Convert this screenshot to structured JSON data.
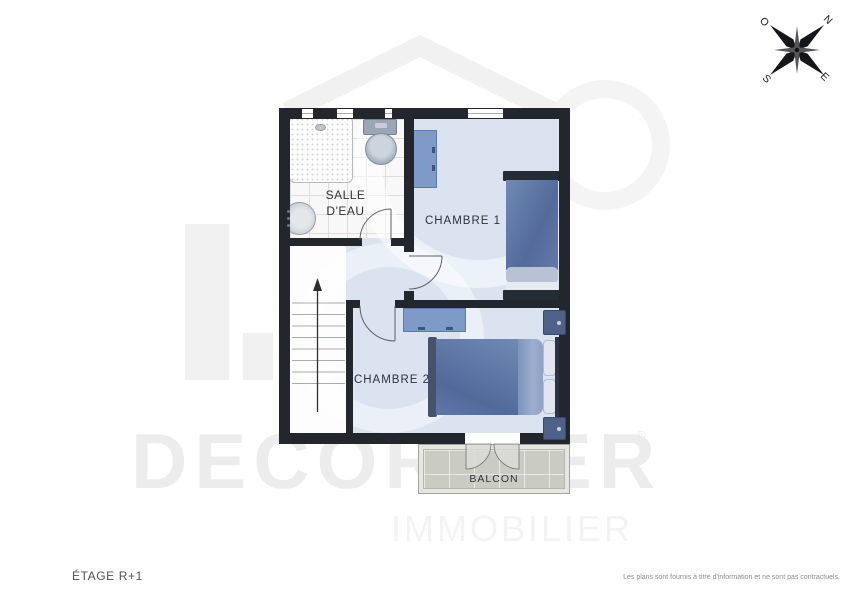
{
  "header": {
    "floor_label": "ÉTAGE R+1"
  },
  "footer": {
    "disclaimer": "Les plans sont fournis à titre d'information et ne sont pas contractuels."
  },
  "watermark": {
    "brand": "DECORDIER",
    "registered_mark": "®",
    "subtitle": "IMMOBILIER"
  },
  "compass": {
    "north": "N",
    "south": "S",
    "east": "E",
    "west": "O"
  },
  "rooms": {
    "bathroom": {
      "label_line1": "SALLE",
      "label_line2": "D'EAU"
    },
    "bedroom1": {
      "label": "CHAMBRE 1"
    },
    "bedroom2": {
      "label": "CHAMBRE 2"
    },
    "balcony": {
      "label": "BALCON"
    }
  },
  "colors": {
    "wall": "#23272d",
    "room-floor": "#dbe2f0",
    "bath-floor": "#f7f8f7",
    "furniture-blue": "#7e9bc7",
    "bed-blanket": "#5e77a5",
    "bed-frame": "#262c36",
    "nightstand": "#4d6189",
    "balcony-floor": "#caccc4",
    "watermark-gray": "#f0f0f0"
  }
}
